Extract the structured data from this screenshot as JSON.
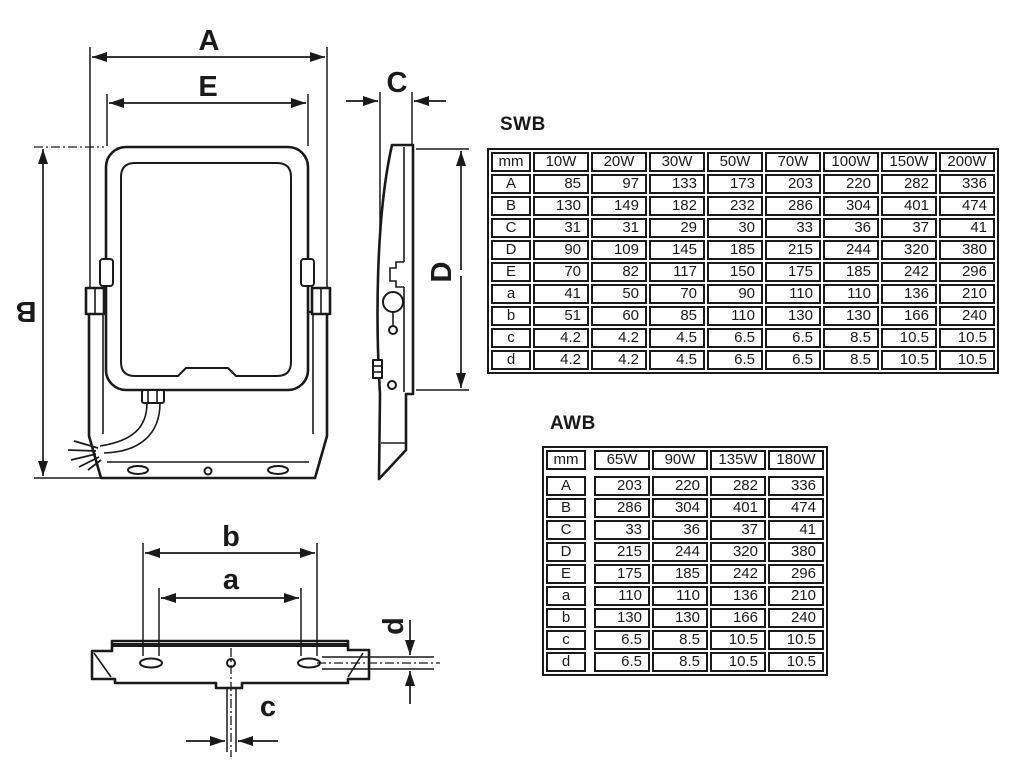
{
  "drawing": {
    "front_view": {
      "overall_width_label": "A",
      "inner_width_label": "E",
      "overall_height_label": "B"
    },
    "side_view": {
      "depth_label": "C",
      "body_height_label": "D"
    },
    "bottom_view": {
      "outer_hole_spacing_label": "b",
      "inner_hole_spacing_label": "a",
      "center_hole_label": "c",
      "slot_height_label": "d"
    }
  },
  "tables": {
    "swb": {
      "title": "SWB",
      "header": [
        "mm",
        "10W",
        "20W",
        "30W",
        "50W",
        "70W",
        "100W",
        "150W",
        "200W"
      ],
      "rows": [
        [
          "A",
          "85",
          "97",
          "133",
          "173",
          "203",
          "220",
          "282",
          "336"
        ],
        [
          "B",
          "130",
          "149",
          "182",
          "232",
          "286",
          "304",
          "401",
          "474"
        ],
        [
          "C",
          "31",
          "31",
          "29",
          "30",
          "33",
          "36",
          "37",
          "41"
        ],
        [
          "D",
          "90",
          "109",
          "145",
          "185",
          "215",
          "244",
          "320",
          "380"
        ],
        [
          "E",
          "70",
          "82",
          "117",
          "150",
          "175",
          "185",
          "242",
          "296"
        ],
        [
          "a",
          "41",
          "50",
          "70",
          "90",
          "110",
          "110",
          "136",
          "210"
        ],
        [
          "b",
          "51",
          "60",
          "85",
          "110",
          "130",
          "130",
          "166",
          "240"
        ],
        [
          "c",
          "4.2",
          "4.2",
          "4.5",
          "6.5",
          "6.5",
          "8.5",
          "10.5",
          "10.5"
        ],
        [
          "d",
          "4.2",
          "4.2",
          "4.5",
          "6.5",
          "6.5",
          "8.5",
          "10.5",
          "10.5"
        ]
      ],
      "spacer": false,
      "header_gap": false
    },
    "awb": {
      "title": "AWB",
      "header": [
        "mm",
        "65W",
        "90W",
        "135W",
        "180W"
      ],
      "rows": [
        [
          "A",
          "203",
          "220",
          "282",
          "336"
        ],
        [
          "B",
          "286",
          "304",
          "401",
          "474"
        ],
        [
          "C",
          "33",
          "36",
          "37",
          "41"
        ],
        [
          "D",
          "215",
          "244",
          "320",
          "380"
        ],
        [
          "E",
          "175",
          "185",
          "242",
          "296"
        ],
        [
          "a",
          "110",
          "110",
          "136",
          "210"
        ],
        [
          "b",
          "130",
          "130",
          "166",
          "240"
        ],
        [
          "c",
          "6.5",
          "8.5",
          "10.5",
          "10.5"
        ],
        [
          "d",
          "6.5",
          "8.5",
          "10.5",
          "10.5"
        ]
      ],
      "spacer": true,
      "header_gap": true
    }
  }
}
